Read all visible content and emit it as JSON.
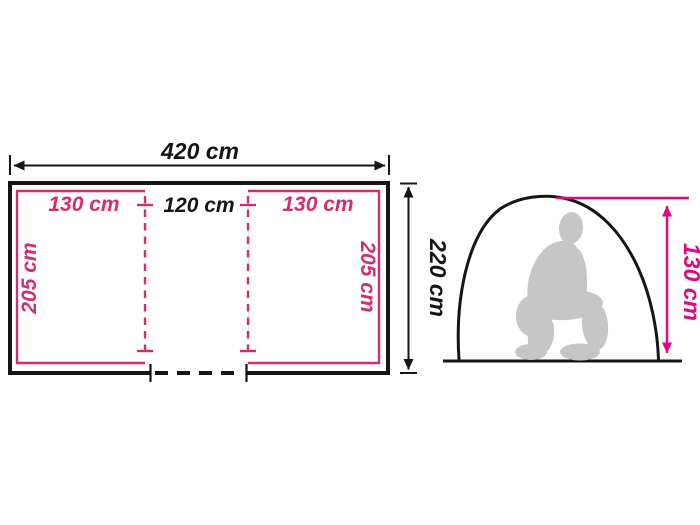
{
  "floor_plan": {
    "total_width_label": "420 cm",
    "total_depth_label": "220 cm",
    "left_room_width_label": "130 cm",
    "left_room_depth_label": "205 cm",
    "center_section_width_label": "120 cm",
    "right_room_width_label": "130 cm",
    "right_room_depth_label": "205 cm"
  },
  "side_view": {
    "peak_height_label": "130 cm"
  },
  "colors": {
    "dimension_pink": "#D12D6F",
    "accent_pink": "#E5077E",
    "line_black": "#151515",
    "silhouette_gray": "#C6C6C6",
    "background": "#FFFFFF"
  }
}
